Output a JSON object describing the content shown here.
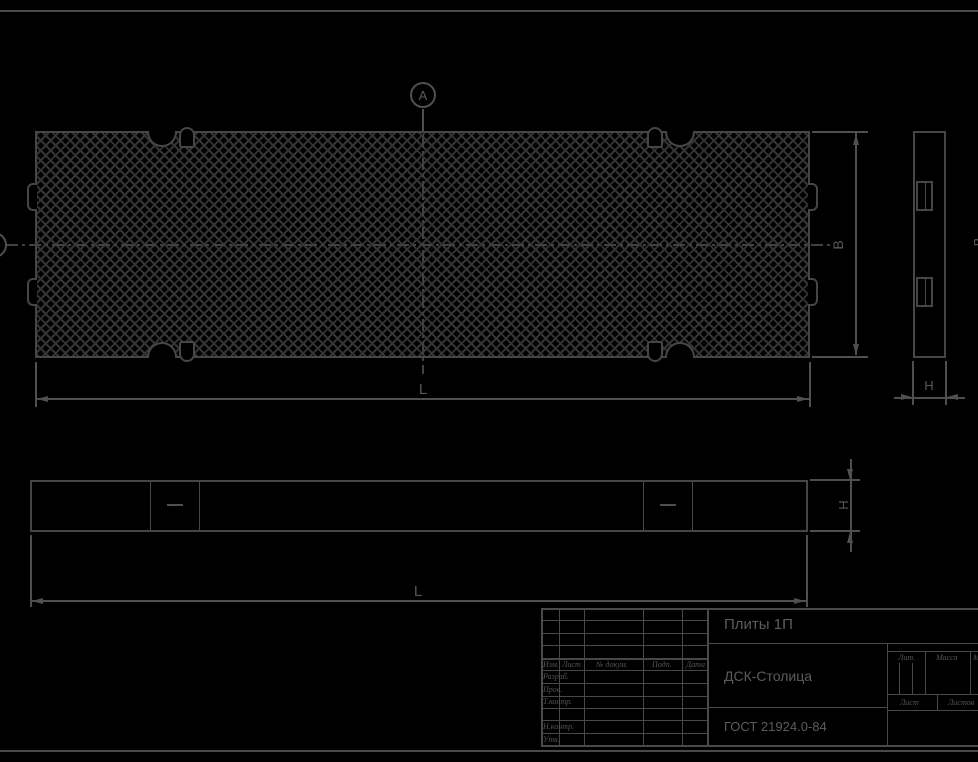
{
  "dims": {
    "B": "В",
    "L": "L",
    "H": "H"
  },
  "markers": {
    "view_a": "А"
  },
  "title_block": {
    "product_title": "Плиты 1П",
    "company": "ДСК-Столица",
    "standard": "ГОСТ 21924.0-84",
    "revision_header": {
      "izm": "Изм.",
      "list": "Лист",
      "doc": "№ докум.",
      "sign": "Подп.",
      "date": "Дата"
    },
    "signature_rows": [
      "Разраб.",
      "Пров.",
      "Т.контр.",
      "Н.контр.",
      "Утв."
    ],
    "right_header": {
      "lit": "Лит.",
      "mass": "Масса",
      "scale": "Масштаб"
    },
    "sheet_labels": {
      "sheet": "Лист",
      "sheets": "Листов"
    }
  }
}
